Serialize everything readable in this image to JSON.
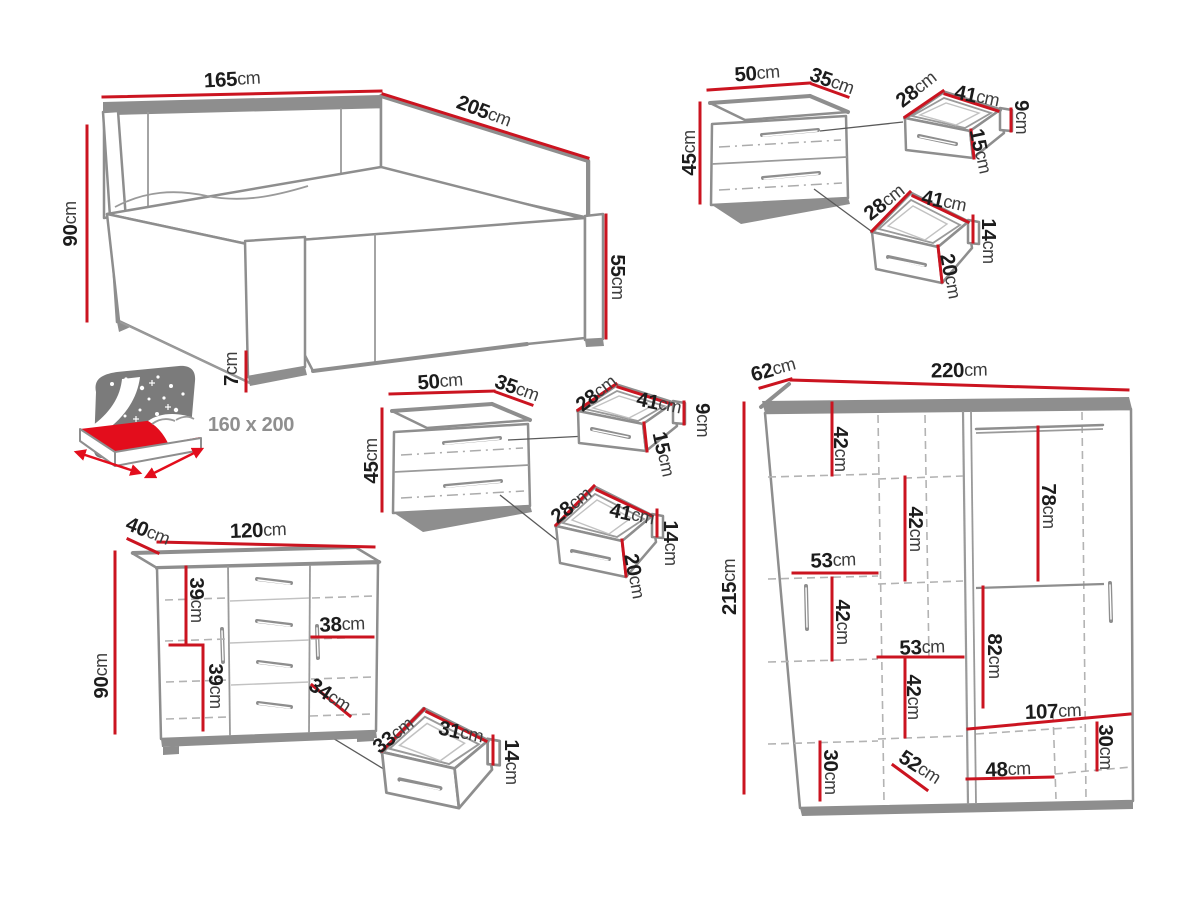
{
  "page": {
    "title": "Bedroom furniture set dimensions diagram",
    "background": "#ffffff"
  },
  "colors": {
    "dimension_line": "#cb1420",
    "furniture_outline": "#8e8e8e",
    "label_number": "#1c1c1c",
    "label_unit": "#3d3d3d",
    "icon_red": "#e30d1c",
    "icon_gray": "#7b7b7b",
    "mattress_text": "#8f8f8f"
  },
  "furniture": [
    {
      "id": "bed",
      "labels": [
        {
          "id": "bed-width",
          "num": "165",
          "unit": "cm"
        },
        {
          "id": "bed-length",
          "num": "205",
          "unit": "cm"
        },
        {
          "id": "bed-headboard-height",
          "num": "90",
          "unit": "cm"
        },
        {
          "id": "bed-footend-height",
          "num": "55",
          "unit": "cm"
        },
        {
          "id": "bed-leg-height",
          "num": "7",
          "unit": "cm"
        },
        {
          "id": "bed-mattress-size",
          "num": "160 x 200",
          "unit": ""
        }
      ]
    },
    {
      "id": "nightstand-top",
      "labels": [
        {
          "id": "ns1-width",
          "num": "50",
          "unit": "cm"
        },
        {
          "id": "ns1-depth",
          "num": "35",
          "unit": "cm"
        },
        {
          "id": "ns1-height",
          "num": "45",
          "unit": "cm"
        }
      ]
    },
    {
      "id": "nightstand-top-drawer-upper",
      "labels": [
        {
          "id": "d1-depth",
          "num": "28",
          "unit": "cm"
        },
        {
          "id": "d1-width",
          "num": "41",
          "unit": "cm"
        },
        {
          "id": "d1-inner-height",
          "num": "9",
          "unit": "cm"
        },
        {
          "id": "d1-front-height",
          "num": "15",
          "unit": "cm"
        }
      ]
    },
    {
      "id": "nightstand-top-drawer-lower",
      "labels": [
        {
          "id": "d2-depth",
          "num": "28",
          "unit": "cm"
        },
        {
          "id": "d2-width",
          "num": "41",
          "unit": "cm"
        },
        {
          "id": "d2-inner-height",
          "num": "14",
          "unit": "cm"
        },
        {
          "id": "d2-front-height",
          "num": "20",
          "unit": "cm"
        }
      ]
    },
    {
      "id": "nightstand-middle",
      "labels": [
        {
          "id": "ns2-width",
          "num": "50",
          "unit": "cm"
        },
        {
          "id": "ns2-depth",
          "num": "35",
          "unit": "cm"
        },
        {
          "id": "ns2-height",
          "num": "45",
          "unit": "cm"
        }
      ]
    },
    {
      "id": "nightstand-middle-drawer-upper",
      "labels": [
        {
          "id": "d3-depth",
          "num": "28",
          "unit": "cm"
        },
        {
          "id": "d3-width",
          "num": "41",
          "unit": "cm"
        },
        {
          "id": "d3-inner-height",
          "num": "9",
          "unit": "cm"
        },
        {
          "id": "d3-front-height",
          "num": "15",
          "unit": "cm"
        }
      ]
    },
    {
      "id": "nightstand-middle-drawer-lower",
      "labels": [
        {
          "id": "d4-depth",
          "num": "28",
          "unit": "cm"
        },
        {
          "id": "d4-width",
          "num": "41",
          "unit": "cm"
        },
        {
          "id": "d4-inner-height",
          "num": "14",
          "unit": "cm"
        },
        {
          "id": "d4-front-height",
          "num": "20",
          "unit": "cm"
        }
      ]
    },
    {
      "id": "dresser",
      "labels": [
        {
          "id": "dresser-depth",
          "num": "40",
          "unit": "cm"
        },
        {
          "id": "dresser-width",
          "num": "120",
          "unit": "cm"
        },
        {
          "id": "dresser-height",
          "num": "90",
          "unit": "cm"
        },
        {
          "id": "dresser-section-height-a",
          "num": "39",
          "unit": "cm"
        },
        {
          "id": "dresser-section-height-b",
          "num": "39",
          "unit": "cm"
        },
        {
          "id": "dresser-inner-width",
          "num": "38",
          "unit": "cm"
        },
        {
          "id": "dresser-drawer-width",
          "num": "34",
          "unit": "cm"
        }
      ]
    },
    {
      "id": "dresser-drawer",
      "labels": [
        {
          "id": "d5-depth",
          "num": "33",
          "unit": "cm"
        },
        {
          "id": "d5-width",
          "num": "31",
          "unit": "cm"
        },
        {
          "id": "d5-front-height",
          "num": "14",
          "unit": "cm"
        }
      ]
    },
    {
      "id": "wardrobe",
      "labels": [
        {
          "id": "wardrobe-depth",
          "num": "62",
          "unit": "cm"
        },
        {
          "id": "wardrobe-width",
          "num": "220",
          "unit": "cm"
        },
        {
          "id": "wardrobe-height",
          "num": "215",
          "unit": "cm"
        },
        {
          "id": "wardrobe-shelf-a",
          "num": "42",
          "unit": "cm"
        },
        {
          "id": "wardrobe-shelf-b",
          "num": "42",
          "unit": "cm"
        },
        {
          "id": "wardrobe-hanging-right",
          "num": "78",
          "unit": "cm"
        },
        {
          "id": "wardrobe-inner-width-left",
          "num": "53",
          "unit": "cm"
        },
        {
          "id": "wardrobe-shelf-c",
          "num": "42",
          "unit": "cm"
        },
        {
          "id": "wardrobe-inner-width-mid",
          "num": "53",
          "unit": "cm"
        },
        {
          "id": "wardrobe-shelf-d",
          "num": "42",
          "unit": "cm"
        },
        {
          "id": "wardrobe-hanging-lower",
          "num": "82",
          "unit": "cm"
        },
        {
          "id": "wardrobe-inner-width-right",
          "num": "107",
          "unit": "cm"
        },
        {
          "id": "wardrobe-bottom-right",
          "num": "30",
          "unit": "cm"
        },
        {
          "id": "wardrobe-bottom-left",
          "num": "30",
          "unit": "cm"
        },
        {
          "id": "wardrobe-diagonal",
          "num": "52",
          "unit": "cm"
        },
        {
          "id": "wardrobe-bottom-width",
          "num": "48",
          "unit": "cm"
        }
      ]
    }
  ]
}
